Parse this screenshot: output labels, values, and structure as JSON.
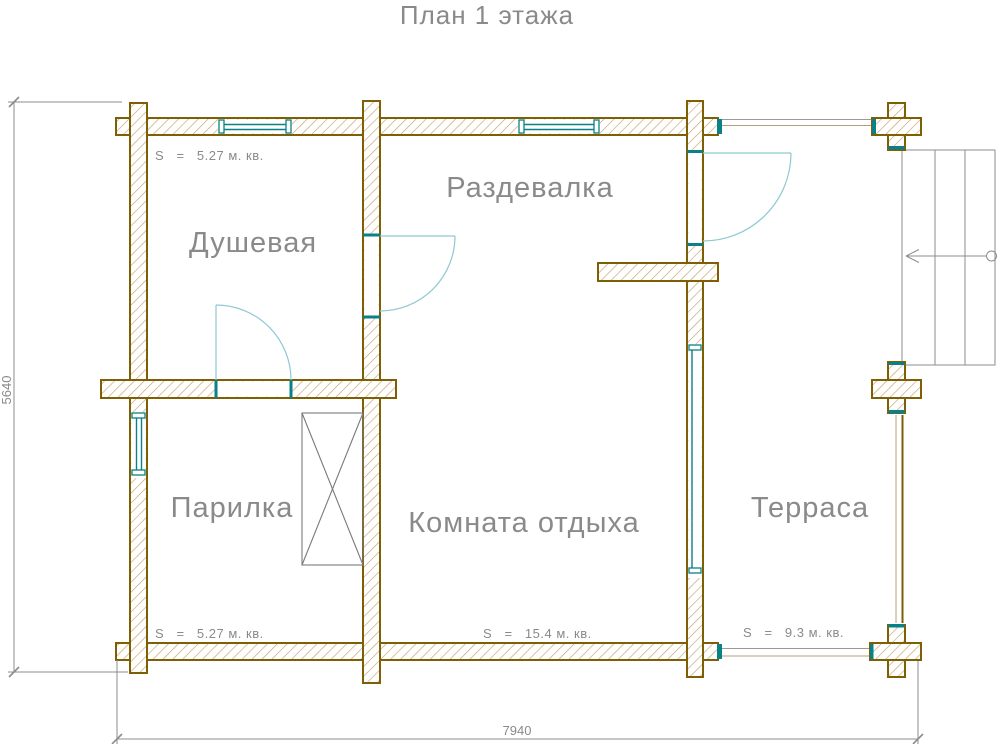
{
  "title": "План 1 этажа",
  "rooms": {
    "shower": {
      "name": "Душевая",
      "area": "S   =   5.27 м. кв."
    },
    "dressing": {
      "name": "Раздевалка"
    },
    "steam": {
      "name": "Парилка",
      "area": "S   =   5.27 м. кв."
    },
    "lounge": {
      "name": "Комната отдыха",
      "area": "S   =   15.4 м. кв."
    },
    "terrace": {
      "name": "Терраса",
      "area": "S   =   9.3 м. кв."
    }
  },
  "dimensions": {
    "total_width": "7940",
    "total_height": "5640"
  },
  "colors": {
    "wall_outline": "#7e5f04",
    "wall_hatch": "#c6a26a",
    "window_frame": "#0a8186",
    "door_swing": "#8ec9d2",
    "label_text": "#8a8a8a",
    "dimension": "#8c8c8c",
    "equipment": "#7a7a7a",
    "railing_light": "#b3a274",
    "railing_gray": "#9a9a9a"
  }
}
